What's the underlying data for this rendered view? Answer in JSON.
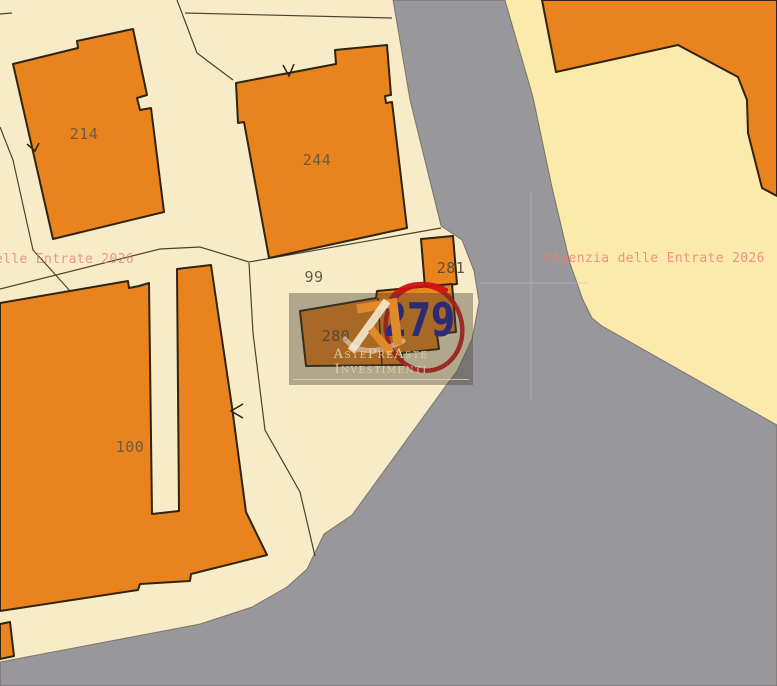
{
  "map": {
    "type": "cadastral-extract",
    "parcels": {
      "p214": "214",
      "p244": "244",
      "p99": "99",
      "p281": "281",
      "p280": "280",
      "p279": "279",
      "p100": "100"
    },
    "highlight": {
      "circled_parcel": "279"
    }
  },
  "watermarks": {
    "left_partial": "elle Entrate 2026",
    "right": "©Agenzia delle Entrate 2026",
    "brand": "AstePreAste Investimenti"
  },
  "colors": {
    "building_fill": "#E8831D",
    "building_outline": "#2E2410",
    "road_gray": "#97979C",
    "parcel_cream": "#F7ECC7",
    "parcel_cream_east": "#FBEAAC",
    "highlight_circle_red": "#CF1212",
    "highlight_number_blue": "#1C1CA4",
    "watermark_pink": "#EC8074",
    "brand_text": "#DED2A8"
  }
}
